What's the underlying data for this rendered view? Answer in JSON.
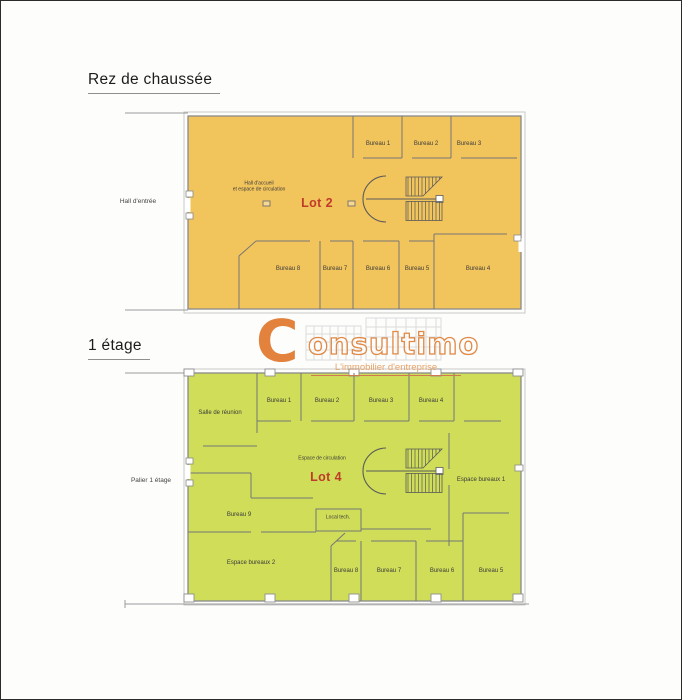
{
  "ground_floor": {
    "title": "Rez de chaussée",
    "lot": "Lot 2",
    "lot_color": "#bf3b2a",
    "fill_color": "#f2c45c",
    "hall_label_line1": "Hall d'accueil",
    "hall_label_line2": "et espace de circulation",
    "outside_label": "Hall d'entrée",
    "rooms": {
      "bureau1": "Bureau 1",
      "bureau2": "Bureau 2",
      "bureau3": "Bureau 3",
      "bureau4": "Bureau 4",
      "bureau5": "Bureau 5",
      "bureau6": "Bureau 6",
      "bureau7": "Bureau 7",
      "bureau8": "Bureau 8"
    }
  },
  "first_floor": {
    "title": "1 étage",
    "lot": "Lot 4",
    "lot_color": "#bf3b2a",
    "fill_color": "#cfdd58",
    "circulation_label": "Espace de circulation",
    "outside_label": "Palier 1 étage",
    "rooms": {
      "salle_reunion": "Salle de réunion",
      "bureau1": "Bureau 1",
      "bureau2": "Bureau 2",
      "bureau3": "Bureau 3",
      "bureau4": "Bureau 4",
      "bureau5": "Bureau 5",
      "bureau6": "Bureau 6",
      "bureau7": "Bureau 7",
      "bureau8": "Bureau 8",
      "bureau9": "Bureau 9",
      "espace_bureaux1": "Espace bureaux 1",
      "espace_bureaux2": "Espace bureaux 2",
      "local_tech": "Local tech."
    }
  },
  "logo": {
    "initial": "C",
    "name_rest": "onsultimo",
    "tagline": "L'immobilier d'entreprise",
    "accent_color": "#e2823c"
  }
}
